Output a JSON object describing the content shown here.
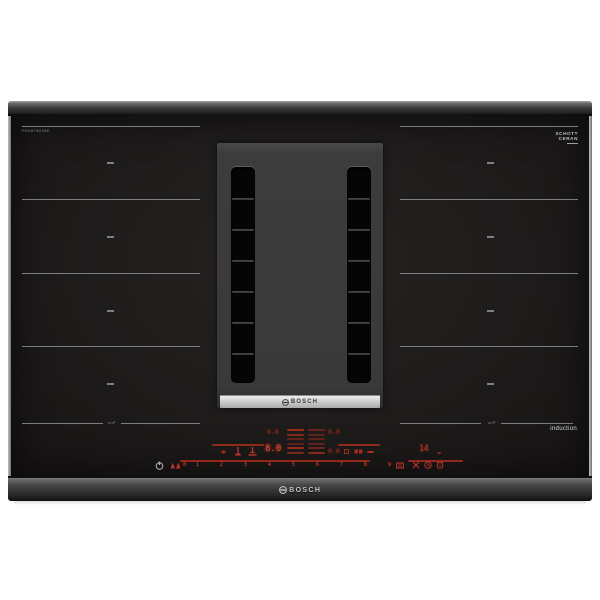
{
  "product": {
    "brand": "BOSCH",
    "model_label": "PXX875D34E",
    "glass_logo_line1": "SCHOTT",
    "glass_logo_line2": "CERAN",
    "induction_label": "induction",
    "zone_marking_left": "vnP",
    "zone_marking_right": "vnP"
  },
  "vent_module": {
    "brand_strip_label": "BOSCH"
  },
  "front_edge": {
    "brand_label": "BOSCH"
  },
  "control_panel": {
    "displays": {
      "aux_top_left": "0.0",
      "aux_top_right": "0.0",
      "power_level": "8.0",
      "aux_mid_right": "0.0",
      "timer": "14"
    },
    "slider": {
      "digits": [
        "0",
        "1",
        "2",
        "3",
        "4",
        "5",
        "6",
        "7",
        "8",
        "9"
      ],
      "separator": "·"
    },
    "colors": {
      "led_red": "#b5352a",
      "led_bright": "#ef4a2a",
      "led_dim": "#8d251b",
      "power_icon_grey": "#b9b9b9"
    },
    "icons": {
      "power": "power-icon",
      "vent_link": "vent-link-icon",
      "zone_dot": "zone-indicator-icon",
      "fan": "fan-icon",
      "hood": "hood-icon",
      "square": "zone-square-icon",
      "double_square": "bridge-zones-icon",
      "minus": "minus-icon",
      "pan": "pan-detect-icon",
      "wipe": "wipe-protection-icon",
      "timer": "timer-icon",
      "alarm": "alarm-icon",
      "bosch_anchor": "bosch-logo-icon"
    }
  }
}
